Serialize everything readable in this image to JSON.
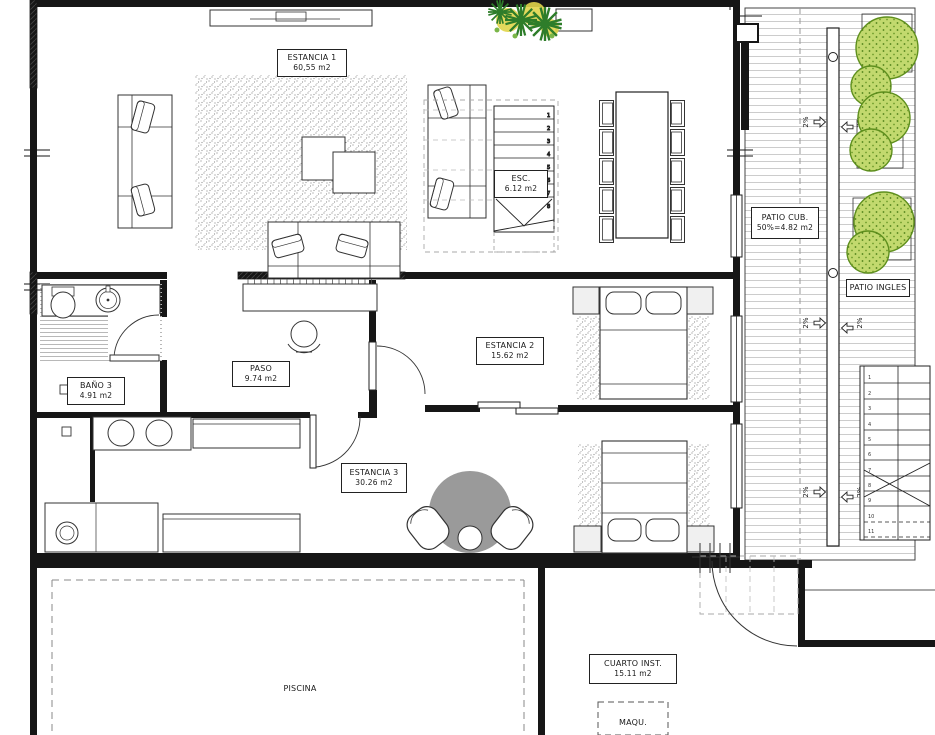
{
  "labels": {
    "estancia1": {
      "name": "ESTANCIA 1",
      "area": "60,55 m2"
    },
    "esc": {
      "name": "ESC.",
      "area": "6.12 m2"
    },
    "patio_cub": {
      "name": "PATIO CUB.",
      "area": "50%=4.82 m2"
    },
    "patio_ingles": {
      "name": "PATIO INGLES"
    },
    "paso": {
      "name": "PASO",
      "area": "9.74 m2"
    },
    "estancia2": {
      "name": "ESTANCIA 2",
      "area": "15.62 m2"
    },
    "bano3": {
      "name": "BAÑO 3",
      "area": "4.91 m2"
    },
    "estancia3": {
      "name": "ESTANCIA 3",
      "area": "30.26 m2"
    },
    "piscina": {
      "name": "PISCINA"
    },
    "cuarto_inst": {
      "name": "CUARTO INST.",
      "area": "15.11 m2"
    },
    "maqu": {
      "name": "MAQU."
    }
  },
  "annotations": {
    "slope_label": "2%",
    "main_stair_numbers": [
      "1",
      "2",
      "3",
      "4",
      "5",
      "6",
      "7",
      "8"
    ],
    "right_stair_numbers": [
      "1",
      "2",
      "3",
      "4",
      "5",
      "6",
      "7",
      "8",
      "9",
      "10",
      "11"
    ]
  },
  "colors": {
    "line": "#1f1f1f",
    "deck_line": "#cccccc",
    "tree_fill": "#c2d96e",
    "tree_stroke": "#5e8f1d",
    "plant_green": "#2e7d2a",
    "plant_yellow": "#e0d54a",
    "rug_gray": "#9a9a9a"
  }
}
